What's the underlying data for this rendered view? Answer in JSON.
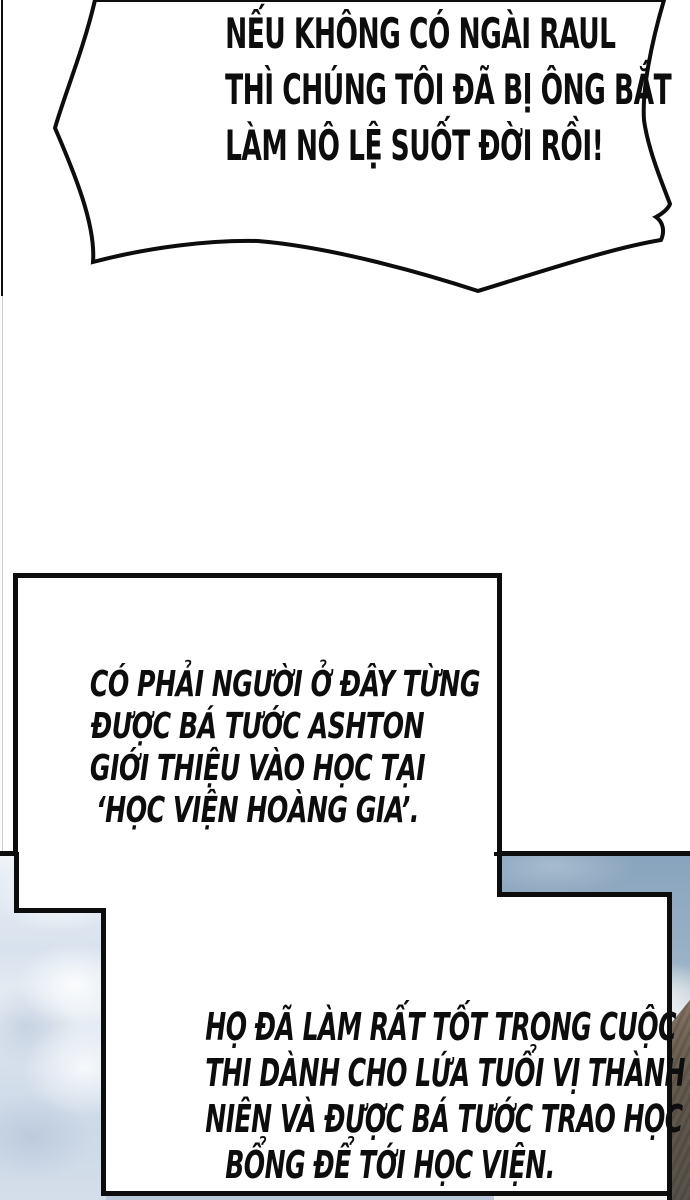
{
  "speech_bubble": {
    "lines": [
      "NẾU KHÔNG CÓ NGÀI RAUL",
      "THÌ CHÚNG TÔI ĐÃ BỊ ÔNG BẮT",
      "LÀM NÔ LỆ SUỐT ĐỜI RỒI!"
    ]
  },
  "caption_box": {
    "lines": [
      "CÓ PHẢI NGƯỜI Ở ĐÂY TỪNG",
      "ĐƯỢC BÁ TƯỚC ASHTON",
      "GIỚI THIỆU VÀO HỌC TẠI",
      "‘HỌC VIỆN HOÀNG GIA’."
    ]
  },
  "bottom_caption": {
    "lines": [
      "HỌ ĐÃ LÀM RẤT TỐT TRONG CUỘC",
      "THI DÀNH CHO LỨA TUỔI VỊ THÀNH",
      "NIÊN VÀ ĐƯỢC BÁ TƯỚC TRAO HỌC",
      "BỔNG ĐỂ TỚI HỌC VIỆN."
    ]
  },
  "colors": {
    "ink": "#0d0d0d",
    "faint": "#cfcfcf",
    "sky-band": "#8ba7c0",
    "clouds-light": "#eef3f7",
    "clouds-mid": "#ccd9e6",
    "cloud-white": "#f5f6f4",
    "brown-light": "#857464",
    "brown-mid": "#6e6254",
    "brown-dark": "#59524a"
  }
}
